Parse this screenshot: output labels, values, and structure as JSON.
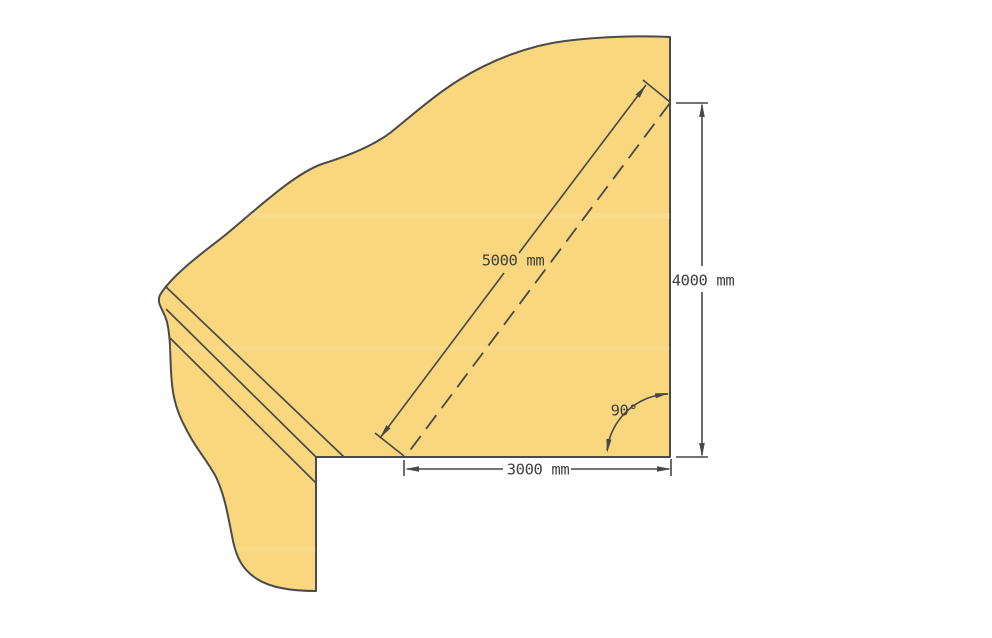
{
  "page": {
    "background_color": "#ffffff"
  },
  "diagram": {
    "kind": "slope-cross-section-drawing",
    "colors": {
      "terrain_fill": "#f9d77e",
      "outline_stroke": "#4a4a4a",
      "dimension_stroke": "#474747",
      "text_color": "#3f3f3f"
    },
    "dimensions": [
      {
        "id": "slope-length",
        "label": "5000 mm",
        "value": 5000,
        "unit": "mm"
      },
      {
        "id": "vertical-height",
        "label": "4000 mm",
        "value": 4000,
        "unit": "mm"
      },
      {
        "id": "horizontal-base",
        "label": "3000 mm",
        "value": 3000,
        "unit": "mm"
      }
    ],
    "angle": {
      "label": "90°",
      "value": 90,
      "unit": "deg"
    }
  }
}
